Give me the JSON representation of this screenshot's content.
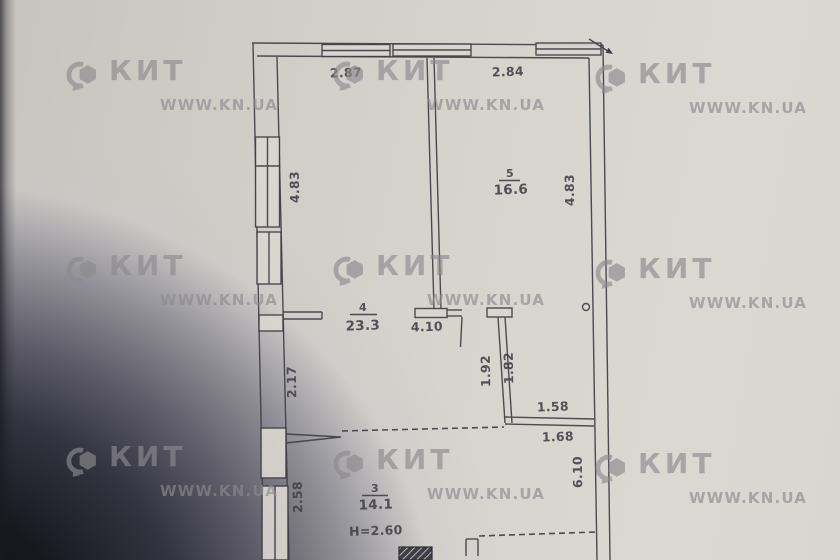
{
  "colors": {
    "paper": "#d9d6d0",
    "ink": "#3f3f45",
    "watermark": "#8c8b8e"
  },
  "watermark": {
    "brand": "КИТ",
    "site": "WWW.KN.UA",
    "positions": [
      {
        "x": 64,
        "y": 57
      },
      {
        "x": 331,
        "y": 57
      },
      {
        "x": 593,
        "y": 60
      },
      {
        "x": 64,
        "y": 252
      },
      {
        "x": 331,
        "y": 252
      },
      {
        "x": 593,
        "y": 255
      },
      {
        "x": 64,
        "y": 443
      },
      {
        "x": 331,
        "y": 446
      },
      {
        "x": 593,
        "y": 450
      }
    ]
  },
  "plan": {
    "rooms": [
      {
        "number": "5",
        "area": "16.6"
      },
      {
        "number": "4",
        "area": "23.3"
      },
      {
        "number": "3",
        "area": "14.1"
      }
    ],
    "ceiling_height": "Н=2.60",
    "dimensions": {
      "top_left": "2.87",
      "top_right": "2.84",
      "left_upper": "4.83",
      "right_upper": "4.83",
      "left_mid": "2.17",
      "left_lower": "2.58",
      "hall_width": "4.10",
      "corridor_depth_outer": "1.92",
      "corridor_depth_inner": "1.82",
      "niche_width_upper": "1.58",
      "niche_width_lower": "1.68",
      "right_lower": "6.10"
    }
  }
}
